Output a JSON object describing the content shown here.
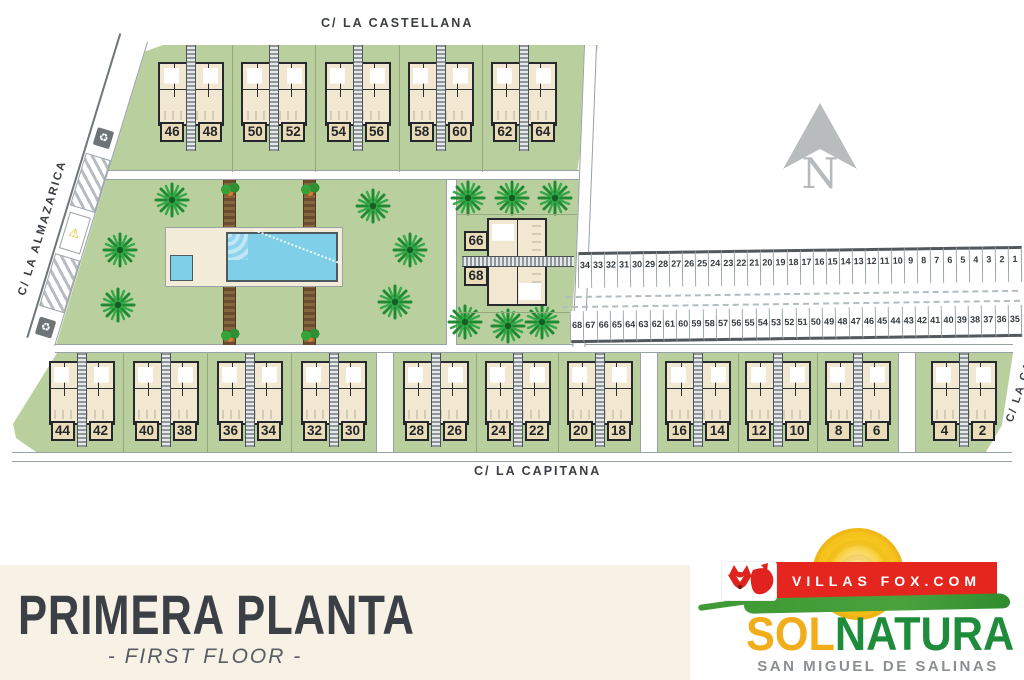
{
  "plan": {
    "street_top": "C/ LA CASTELLANA",
    "street_left": "C/ LA ALMAZARICA",
    "street_bottom": "C/ LA CAPITANA",
    "street_right": "C/ LA CAN",
    "north_label": "N",
    "icons": {
      "recycle": "♻",
      "warning": "⚠"
    },
    "top_blocks": [
      [
        "46",
        "48"
      ],
      [
        "50",
        "52"
      ],
      [
        "54",
        "56"
      ],
      [
        "58",
        "60"
      ],
      [
        "62",
        "64"
      ]
    ],
    "mid_block": {
      "a": "66",
      "b": "68"
    },
    "bottom_groups": {
      "g1": [
        [
          "44",
          "42"
        ],
        [
          "40",
          "38"
        ],
        [
          "36",
          "34"
        ],
        [
          "32",
          "30"
        ]
      ],
      "g2": [
        [
          "28",
          "26"
        ],
        [
          "24",
          "22"
        ],
        [
          "20",
          "18"
        ]
      ],
      "g3": [
        [
          "16",
          "14"
        ],
        [
          "12",
          "10"
        ],
        [
          "8",
          "6"
        ]
      ],
      "g4": [
        [
          "4",
          "2"
        ]
      ]
    },
    "parking_top": [
      "34",
      "33",
      "32",
      "31",
      "30",
      "29",
      "28",
      "27",
      "26",
      "25",
      "24",
      "23",
      "22",
      "21",
      "20",
      "19",
      "18",
      "17",
      "16",
      "15",
      "14",
      "13",
      "12",
      "11",
      "10",
      "9",
      "8",
      "7",
      "6",
      "5",
      "4",
      "3",
      "2",
      "1"
    ],
    "parking_bottom": [
      "68",
      "67",
      "66",
      "65",
      "64",
      "63",
      "62",
      "61",
      "60",
      "59",
      "58",
      "57",
      "56",
      "55",
      "54",
      "53",
      "52",
      "51",
      "50",
      "49",
      "48",
      "47",
      "46",
      "45",
      "44",
      "43",
      "42",
      "41",
      "40",
      "39",
      "38",
      "37",
      "36",
      "35"
    ]
  },
  "banner": {
    "title": "PRIMERA PLANTA",
    "subtitle": "- FIRST FLOOR -"
  },
  "logo": {
    "domain": "VILLAS FOX.COM",
    "brand_sol": "SOL",
    "brand_natura": "NATURA",
    "subtitle": "SAN MIGUEL DE SALINAS"
  },
  "colors": {
    "grass": "#b9d09e",
    "pool": "#7fcfe9",
    "building": "#f2e8d2",
    "banner_bg": "#f8f1e6",
    "logo_red": "#e5261f",
    "sun": "#f6c31e",
    "sol_yellow": "#f2ad1a",
    "natura_green": "#1e8c3a"
  }
}
